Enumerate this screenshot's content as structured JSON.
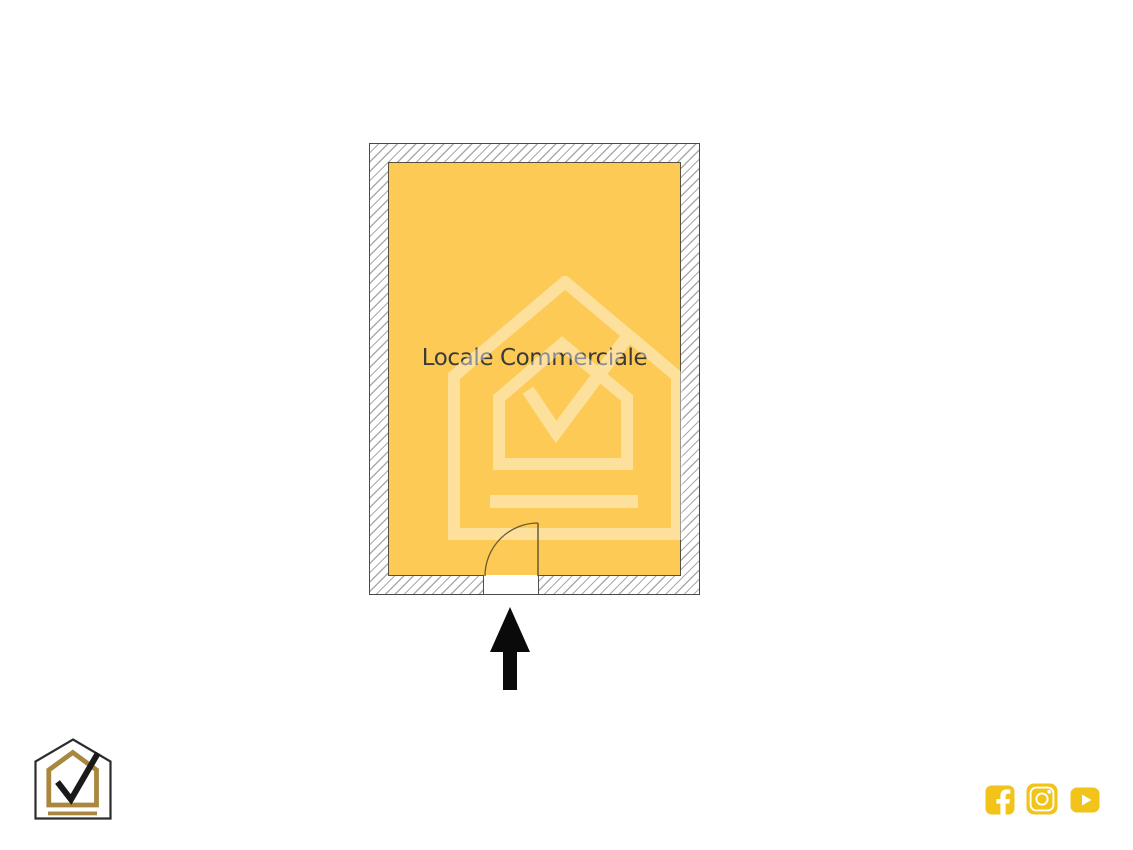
{
  "floor_plan": {
    "room_label": "Locale Commerciale",
    "fill_color": "#fcca55",
    "wall_hatch_color": "#ababab",
    "wall_fill_color": "#ffffff",
    "outline_color": "#4a4a4a",
    "inner_border_color": "#55503e",
    "door_color": "#6b5a31",
    "label_color": "#3a3a3a"
  },
  "watermark": {
    "icon": "house-check-watermark",
    "color": "#ffffff",
    "opacity": 0.42
  },
  "entrance_arrow": {
    "icon": "up-arrow",
    "direction": "up",
    "color": "#0a0a0a"
  },
  "branding_logo": {
    "icon": "house-check-logo",
    "outline_color": "#2d2d2d",
    "accent_color": "#a9873f",
    "check_color": "#1a1a1a"
  },
  "social": {
    "accent_color": "#f2c318",
    "glyph_color": "#ffffff",
    "icons": [
      {
        "name": "facebook"
      },
      {
        "name": "instagram"
      },
      {
        "name": "youtube"
      }
    ]
  }
}
